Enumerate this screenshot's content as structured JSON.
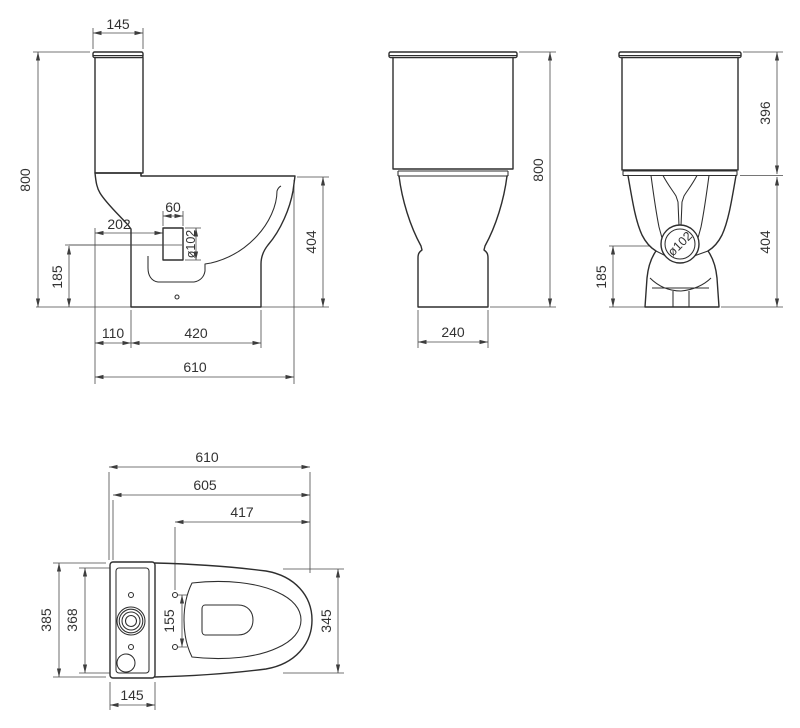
{
  "drawing": {
    "subject": "close-coupled-toilet-dimension-drawing",
    "colors": {
      "background": "#ffffff",
      "outline": "#2e2e2e",
      "dimension": "#4a4a4a",
      "text": "#323232"
    },
    "views": {
      "side": {
        "name": "side-view",
        "dims": {
          "cistern_depth": "145",
          "total_height": "800",
          "outlet_stub_width": "60",
          "outlet_setback": "202",
          "outlet_diameter": "ø102",
          "outlet_center_height": "185",
          "bowl_height": "404",
          "foot_offset": "110",
          "foot_length": "420",
          "total_depth": "610"
        }
      },
      "front": {
        "name": "front-view",
        "dims": {
          "total_height": "800",
          "base_width": "240"
        }
      },
      "rear": {
        "name": "rear-view",
        "dims": {
          "cistern_height": "396",
          "outlet_diameter": "ø102",
          "bowl_height": "404",
          "outlet_center_height": "185"
        }
      },
      "top": {
        "name": "top-view",
        "dims": {
          "total_depth": "610",
          "depth_without_lid": "605",
          "hinge_to_front": "417",
          "cistern_width": "385",
          "cistern_inner_width": "368",
          "hinge_hole_spacing": "155",
          "bowl_width": "345",
          "cistern_depth": "145"
        }
      }
    }
  }
}
